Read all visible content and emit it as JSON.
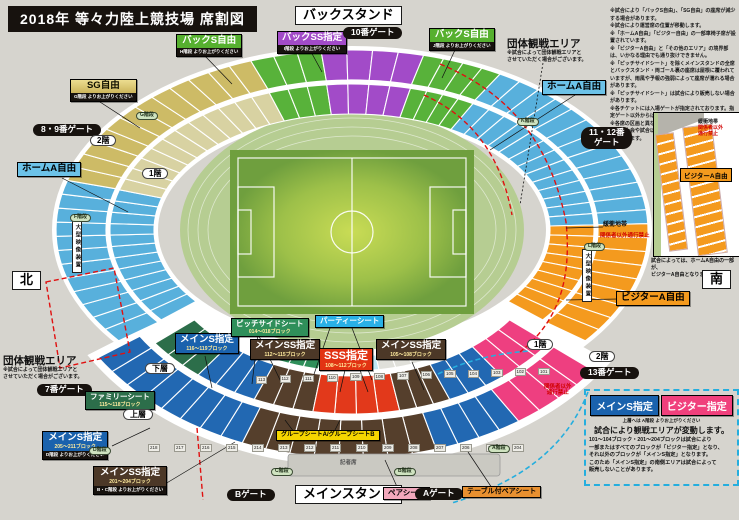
{
  "title": "2018年  等々力陸上競技場  席割図",
  "notes_top_right": "※試合により「バックS自由」、「SG自由」の座席が減少する場合があります。\n※試合により運営席の位置が移動します。\n※「ホームA自由」「ビジター自由」の一部車椅子席が設置されています。\n※「ビジターA自由」と「その他のエリア」の境界部は、いかなる理由でも通り抜けできません。\n※「ピッチサイドシート」を除くメインスタンドの全席とバックスタンド・両ゴール裏の座席は屋根に覆われていますが、雨風や予報の強弱によって座席が濡れる場合があります。\n※「ピッチサイドシート」は試合により販売しない場合があります。\n※各チケットには入場ゲートが指定されております。指定ゲート以外からは入場できません。\n※各席の区画と異なるエリアでの観戦はできません。\n※毎年大会や試合以外の開催の際、座席が変更になる場合があります。",
  "palette": {
    "home_a": "#58b0dc",
    "sg": "#cdbb66",
    "back_s": "#58b23a",
    "back_ss": "#a24bc8",
    "visitor": "#f49a1e",
    "main_s": "#2268b2",
    "main_ss": "#553f2c",
    "sss": "#e2391b",
    "family": "#2c6e4a",
    "visitor_shitei": "#ee3f80",
    "pale": "#d8d2a2",
    "pitchside": "#2f8f5a",
    "party": "#bfe8f5",
    "aisle": "#e0e0da",
    "track": "#b6cd92",
    "field_center": "#c9dc55",
    "field_edge": "#6f9f3e"
  },
  "labels": [
    {
      "id": "back-stand-title",
      "style": "frame",
      "x": 295,
      "y": 6,
      "text": "バックスタンド"
    },
    {
      "id": "back-ss-shitei-label",
      "style": "box c-purple",
      "x": 277,
      "y": 31,
      "text": "バックSS指定",
      "strip": "I階段 よりお上がりください"
    },
    {
      "id": "gate-10",
      "style": "pillb",
      "x": 343,
      "y": 27,
      "text": "10番ゲート"
    },
    {
      "id": "back-s-jiyu-left-label",
      "style": "box c-green",
      "x": 176,
      "y": 34,
      "text": "バックS自由",
      "strip": "H階段 よりお上がりください"
    },
    {
      "id": "back-s-jiyu-right-label",
      "style": "box c-green",
      "x": 429,
      "y": 28,
      "text": "バックS自由",
      "strip": "J階段 よりお上がりください"
    },
    {
      "id": "sg-jiyu-label",
      "style": "box c-gold",
      "x": 70,
      "y": 79,
      "text": "SG自由",
      "strip": "G階段 よりお上がりください"
    },
    {
      "id": "gate-8-9",
      "style": "pillb",
      "x": 33,
      "y": 124,
      "text": "8・9番ゲート"
    },
    {
      "id": "floor-2-left",
      "style": "pillw",
      "x": 90,
      "y": 135,
      "text": "2階"
    },
    {
      "id": "floor-1-left",
      "style": "pillw",
      "x": 142,
      "y": 168,
      "text": "1階"
    },
    {
      "id": "home-a-jiyu-left-label",
      "style": "box c-lblue",
      "x": 17,
      "y": 162,
      "text": "ホームA自由"
    },
    {
      "id": "compass-north",
      "style": "frame",
      "x": 12,
      "y": 271,
      "text": "北"
    },
    {
      "id": "group-area-top",
      "style": "gtitle",
      "x": 507,
      "y": 38,
      "text": "団体観戦エリア",
      "gnote": "※試合によって団体観戦エリアと\nさせていただく場合がございます。"
    },
    {
      "id": "home-a-jiyu-right-label",
      "style": "box c-lblue",
      "x": 542,
      "y": 80,
      "text": "ホームA自由"
    },
    {
      "id": "gate-11-12",
      "style": "pillb pre",
      "x": 581,
      "y": 127,
      "text": "11・12番\nゲート"
    },
    {
      "id": "buffer-zone-map",
      "style": "tiny",
      "x": 603,
      "y": 222,
      "text": "緩衝地帯"
    },
    {
      "id": "no-entry-map",
      "style": "tinyred",
      "x": 600,
      "y": 233,
      "text": "関係者以外通行禁止"
    },
    {
      "id": "video-screen-left",
      "style": "screen",
      "x": 72,
      "y": 220,
      "text": "大型映像装置"
    },
    {
      "id": "video-screen-right",
      "style": "screen",
      "x": 582,
      "y": 249,
      "text": "大型映像装置"
    },
    {
      "id": "visitor-a-jiyu-map-label",
      "style": "box c-orange",
      "x": 616,
      "y": 291,
      "text": "ビジターA自由"
    },
    {
      "id": "floor-1-right",
      "style": "pillw",
      "x": 527,
      "y": 339,
      "text": "1階"
    },
    {
      "id": "floor-2-right",
      "style": "pillw",
      "x": 589,
      "y": 351,
      "text": "2階"
    },
    {
      "id": "gate-13",
      "style": "pillb",
      "x": 580,
      "y": 367,
      "text": "13番ゲート"
    },
    {
      "id": "group-area-bottom",
      "style": "gtitle",
      "x": 3,
      "y": 355,
      "text": "団体観戦エリア",
      "gnote": "※試合によって団体観戦エリアと\nさせていただく場合がございます。"
    },
    {
      "id": "gate-7",
      "style": "pillb",
      "x": 37,
      "y": 384,
      "text": "7番ゲート"
    },
    {
      "id": "family-seat-label",
      "style": "box c-dgreen fs8",
      "x": 85,
      "y": 391,
      "text": "ファミリーシート",
      "sub": "115〜118ブロック"
    },
    {
      "id": "lower-tier",
      "style": "pillw",
      "x": 145,
      "y": 363,
      "text": "下層"
    },
    {
      "id": "upper-tier",
      "style": "pillw",
      "x": 123,
      "y": 409,
      "text": "上層"
    },
    {
      "id": "main-s-shitei-205-label",
      "style": "box c-blue",
      "x": 42,
      "y": 431,
      "text": "メインS指定",
      "sub": "205〜211ブロック",
      "strip": "D階段 よりお上がりください"
    },
    {
      "id": "main-ss-shitei-201-label",
      "style": "box c-brown",
      "x": 93,
      "y": 466,
      "text": "メインSS指定",
      "sub": "201〜204ブロック",
      "strip": "B・C階段 よりお上がりください"
    },
    {
      "id": "main-s-shitei-116-label",
      "style": "box c-blue",
      "x": 175,
      "y": 333,
      "text": "メインS指定",
      "sub": "116〜119ブロック"
    },
    {
      "id": "pitchside-seat-label",
      "style": "box c-pitch fs8",
      "x": 231,
      "y": 318,
      "text": "ピッチサイドシート",
      "sub": "014〜018ブロック"
    },
    {
      "id": "party-seat-label",
      "style": "box c-cyan fs8",
      "x": 315,
      "y": 315,
      "text": "パーティーシート"
    },
    {
      "id": "main-ss-shitei-112-label",
      "style": "box c-brown",
      "x": 250,
      "y": 339,
      "text": "メインSS指定",
      "sub": "112〜115ブロック"
    },
    {
      "id": "sss-shitei-label",
      "style": "box c-red fs11",
      "x": 319,
      "y": 348,
      "text": "SSS指定",
      "sub": "108〜112ブロック"
    },
    {
      "id": "main-ss-shitei-105-label",
      "style": "box c-brown",
      "x": 376,
      "y": 339,
      "text": "メインSS指定",
      "sub": "105〜108ブロック"
    },
    {
      "id": "no-entry-right",
      "style": "tinyred pre",
      "x": 544,
      "y": 384,
      "text": "関係者以外\n通行禁止"
    },
    {
      "id": "group-seat-ab-label",
      "style": "box c-yellow fs6",
      "x": 276,
      "y": 430,
      "text": "グループシートA/グループシートB"
    },
    {
      "id": "gate-b",
      "style": "pillb",
      "x": 227,
      "y": 489,
      "text": "Bゲート"
    },
    {
      "id": "main-stand-title",
      "style": "frame",
      "x": 295,
      "y": 485,
      "text": "メインスタンド"
    },
    {
      "id": "pair-seat-label",
      "style": "box c-pink fs8",
      "x": 383,
      "y": 487,
      "text": "ペアシート"
    },
    {
      "id": "gate-a",
      "style": "pillb",
      "x": 415,
      "y": 488,
      "text": "Aゲート"
    },
    {
      "id": "table-pair-seat-label",
      "style": "box c-torange fs7",
      "x": 462,
      "y": 486,
      "text": "テーブル付ペアシート"
    },
    {
      "id": "stair-f",
      "style": "stair",
      "x": 70,
      "y": 214,
      "text": "F階段"
    },
    {
      "id": "stair-g",
      "style": "stair",
      "x": 136,
      "y": 112,
      "text": "G階段"
    },
    {
      "id": "stair-k",
      "style": "stair",
      "x": 517,
      "y": 118,
      "text": "K階段"
    },
    {
      "id": "stair-l",
      "style": "stair",
      "x": 584,
      "y": 243,
      "text": "L階段"
    },
    {
      "id": "stair-d",
      "style": "stair",
      "x": 89,
      "y": 447,
      "text": "D階段"
    },
    {
      "id": "stair-c",
      "style": "stair",
      "x": 271,
      "y": 468,
      "text": "C階段"
    },
    {
      "id": "stair-b",
      "style": "stair",
      "x": 394,
      "y": 468,
      "text": "B階段"
    },
    {
      "id": "stair-a",
      "style": "stair",
      "x": 488,
      "y": 445,
      "text": "A階段"
    },
    {
      "id": "press-seats",
      "style": "tgray",
      "x": 340,
      "y": 460,
      "text": "記者席"
    }
  ],
  "info_box": {
    "main_s": "メインS指定",
    "visitor_s": "ビジター指定",
    "stair_note": "上層へは A階段 よりお上がりください",
    "headline": "試合により観戦エリアが変動します。",
    "body": "101〜104ブロック・201〜204ブロックは試合により\n一部またはすべてのブロックが「ビジター指定」となり、\nそれ以外のブロックが「メインS指定」となります。\nこのため「メインS指定」の南側エリアは試合によって\n販売しないことがあります。"
  },
  "inset": {
    "buffer": "緩衝地帯",
    "no_entry": "関係者以外\n通行禁止",
    "visitor_label": "ビジターA自由",
    "note": "試合によっては、ホームA自由の一部が、\nビジターA自由となります。",
    "south": "南"
  },
  "block_numbers": {
    "lower": [
      "113",
      "112",
      "111",
      "110",
      "109",
      "108",
      "107",
      "106",
      "105",
      "104",
      "103",
      "102",
      "101"
    ],
    "upper": [
      "218",
      "217",
      "216",
      "215",
      "214",
      "213",
      "212",
      "211",
      "210",
      "209",
      "208",
      "207",
      "206",
      "205",
      "204"
    ]
  }
}
